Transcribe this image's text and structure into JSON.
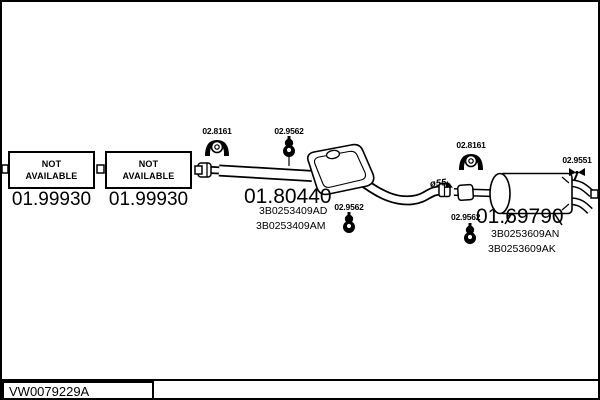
{
  "frame": {
    "drawing_number": "VW0079229A"
  },
  "boxes": [
    {
      "line1": "NOT",
      "line2": "AVAILABLE",
      "ref": "01.99930"
    },
    {
      "line1": "NOT",
      "line2": "AVAILABLE",
      "ref": "01.99930"
    }
  ],
  "parts": [
    {
      "ref": "01.80440",
      "numbers": [
        "3B0253409AD",
        "3B0253409AM"
      ]
    },
    {
      "ref": "01.69790",
      "numbers": [
        "3B0253609AN",
        "3B0253609AK"
      ]
    }
  ],
  "fittings": {
    "clamp_front": "02.8161",
    "hanger_front": "02.9562",
    "hanger_mid": "02.9562",
    "clamp_rear": "02.8161",
    "hanger_rear": "02.9562",
    "hanger_tail": "02.9551",
    "pipe_diameter": "ø55"
  },
  "icons": {
    "clamp": "exhaust-clamp-icon",
    "rubber_hanger": "rubber-mount-icon",
    "tail_hanger": "tail-bracket-icon"
  },
  "colors": {
    "ink": "#000000",
    "background": "#ffffff"
  }
}
